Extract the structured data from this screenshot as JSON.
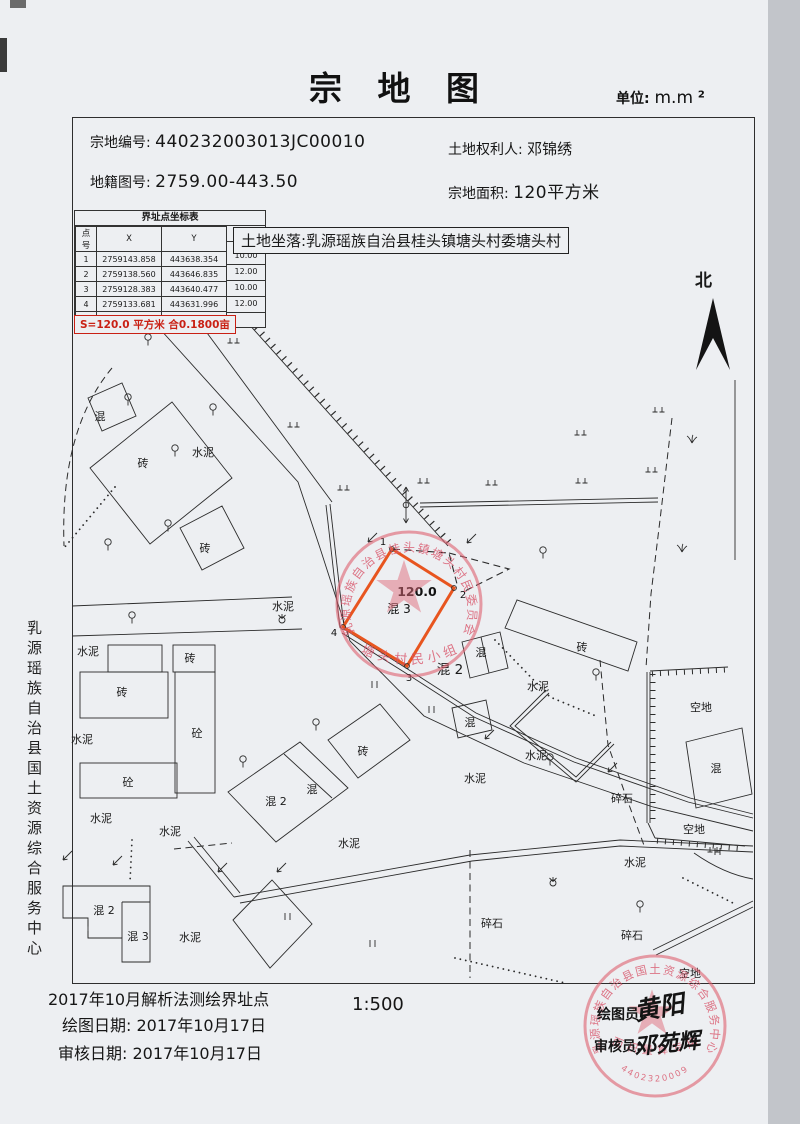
{
  "page": {
    "title": "宗 地 图",
    "unit_label": "单位:",
    "unit_value": "m.m",
    "unit_sup": "2"
  },
  "fields": {
    "parcel_no_label": "宗地编号:",
    "parcel_no": "440232003013JC00010",
    "owner_label": "土地权利人:",
    "owner": "邓锦绣",
    "map_no_label": "地籍图号:",
    "map_no": "2759.00-443.50",
    "area_label": "宗地面积:",
    "area": "120平方米"
  },
  "coord_table": {
    "title": "界址点坐标表",
    "col_pt": "点号",
    "col_x": "X",
    "col_y": "Y",
    "col_len": "边长",
    "rows": [
      {
        "pt": "1",
        "x": "2759143.858",
        "y": "443638.354"
      },
      {
        "pt": "2",
        "x": "2759138.560",
        "y": "443646.835"
      },
      {
        "pt": "3",
        "x": "2759128.383",
        "y": "443640.477"
      },
      {
        "pt": "4",
        "x": "2759133.681",
        "y": "443631.996"
      },
      {
        "pt": "1",
        "x": "2759143.858",
        "y": "443638.354"
      }
    ],
    "edge_lengths": [
      "10.00",
      "12.00",
      "10.00",
      "12.00"
    ],
    "area_line": "S=120.0 平方米 合0.1800亩"
  },
  "location": {
    "text": "土地坐落:乳源瑶族自治县桂头镇塘头村委塘头村"
  },
  "north": {
    "label": "北"
  },
  "map": {
    "parcel": {
      "area_label": "120.0",
      "type_label": "混 3",
      "vertices": [
        "1",
        "2",
        "3",
        "4"
      ]
    },
    "labels": [
      {
        "t": "混",
        "x": 100,
        "y": 420
      },
      {
        "t": "砖",
        "x": 143,
        "y": 467
      },
      {
        "t": "水泥",
        "x": 203,
        "y": 456
      },
      {
        "t": "砖",
        "x": 205,
        "y": 552
      },
      {
        "t": "水泥",
        "x": 283,
        "y": 610
      },
      {
        "t": "水泥",
        "x": 88,
        "y": 655
      },
      {
        "t": "砖",
        "x": 122,
        "y": 696
      },
      {
        "t": "砖",
        "x": 190,
        "y": 662
      },
      {
        "t": "砼",
        "x": 197,
        "y": 737
      },
      {
        "t": "砼",
        "x": 128,
        "y": 786
      },
      {
        "t": "水泥",
        "x": 82,
        "y": 743
      },
      {
        "t": "水泥",
        "x": 101,
        "y": 822
      },
      {
        "t": "水泥",
        "x": 170,
        "y": 835
      },
      {
        "t": "混 2",
        "x": 276,
        "y": 805
      },
      {
        "t": "混",
        "x": 312,
        "y": 793
      },
      {
        "t": "砖",
        "x": 363,
        "y": 755
      },
      {
        "t": "水泥",
        "x": 349,
        "y": 847
      },
      {
        "t": "混 2",
        "x": 104,
        "y": 914
      },
      {
        "t": "混 3",
        "x": 138,
        "y": 940
      },
      {
        "t": "水泥",
        "x": 190,
        "y": 941
      },
      {
        "t": "砖",
        "x": 582,
        "y": 651
      },
      {
        "t": "水泥",
        "x": 538,
        "y": 690
      },
      {
        "t": "混",
        "x": 481,
        "y": 656
      },
      {
        "t": "混 2",
        "x": 450,
        "y": 674,
        "cls": "lg"
      },
      {
        "t": "混",
        "x": 470,
        "y": 726
      },
      {
        "t": "水泥",
        "x": 536,
        "y": 759
      },
      {
        "t": "碎石",
        "x": 622,
        "y": 802
      },
      {
        "t": "空地",
        "x": 701,
        "y": 711
      },
      {
        "t": "混",
        "x": 716,
        "y": 772
      },
      {
        "t": "空地",
        "x": 694,
        "y": 833
      },
      {
        "t": "水泥",
        "x": 475,
        "y": 782
      },
      {
        "t": "水泥",
        "x": 635,
        "y": 866
      },
      {
        "t": "碎石",
        "x": 492,
        "y": 927
      },
      {
        "t": "碎石",
        "x": 632,
        "y": 939
      },
      {
        "t": "空地",
        "x": 690,
        "y": 977
      }
    ]
  },
  "stamps": {
    "village": {
      "ring": "乳源瑶族自治县桂头镇塘头村民委员会",
      "inner": "塘头村民小组"
    },
    "office": {
      "ring": "乳源瑶族自治县国土资源综合服务中心",
      "banner": "面积量算专用",
      "code": "4402320009"
    }
  },
  "footer": {
    "method_line": "2017年10月解析法测绘界址点",
    "draw_date_label": "绘图日期:",
    "draw_date": "2017年10月17日",
    "review_date_label": "审核日期:",
    "review_date": "2017年10月17日",
    "scale": "1:500",
    "drafter_label": "绘图员:",
    "drafter_sig": "黄阳",
    "reviewer_label": "审核员:",
    "reviewer_sig": "邓苑辉"
  },
  "sidebar": {
    "vertical_text": "乳源瑶族自治县国土资源综合服务中心"
  }
}
